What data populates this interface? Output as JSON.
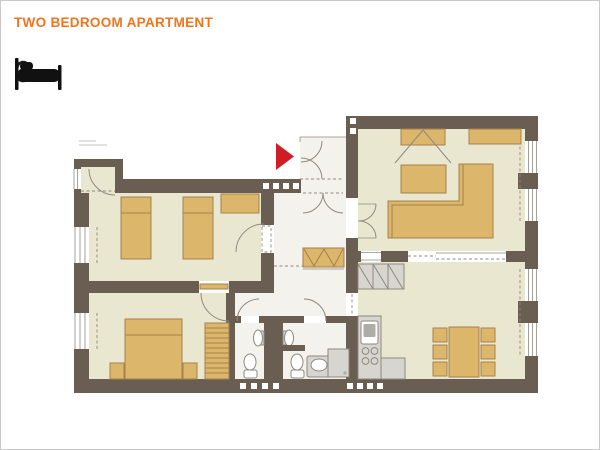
{
  "header": {
    "title": "TWO BEDROOM APARTMENT",
    "capacity": "6"
  },
  "icons": {
    "bed_icon": "bed-pictogram",
    "entrance_arrow": "right-pointing-triangle"
  },
  "colors": {
    "wall": "#6a5d51",
    "floor": "#eae7d1",
    "floor-hall": "#f4f2ec",
    "furniture": "#dcb66a",
    "furniture-stroke": "#a5824a",
    "appliance": "#d7d5d0",
    "appliance-dark": "#aeaca7",
    "line": "#8f897f",
    "accent": "#cf1d26",
    "title": "#f2741d",
    "ink": "#1d1d1b",
    "frame": "#c9c9c9",
    "fixture": "#ffffff"
  }
}
